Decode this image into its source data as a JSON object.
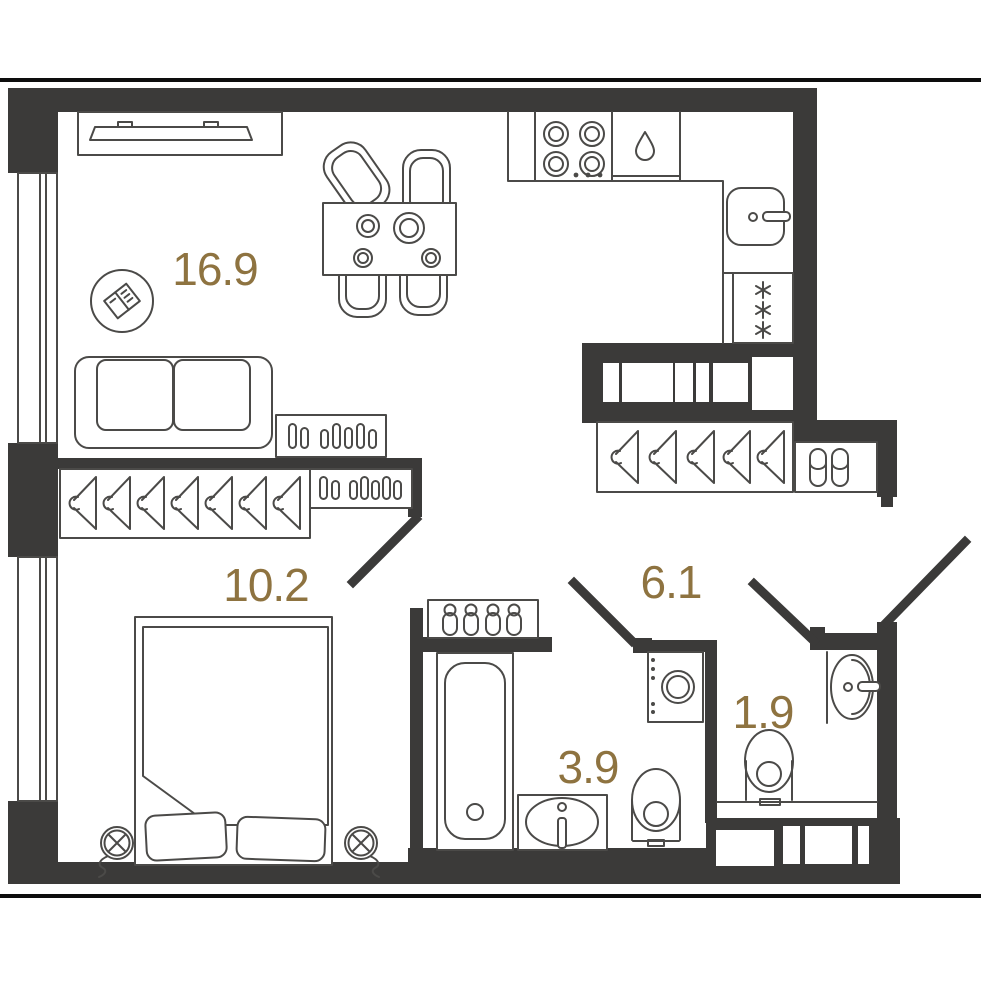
{
  "plan": {
    "accent_color": "#8e7340",
    "wall_color": "#3b3a39",
    "line_color": "#4b4a48",
    "background_color": "#ffffff",
    "rooms": [
      {
        "id": "living-kitchen",
        "area_label": "16.9"
      },
      {
        "id": "bedroom",
        "area_label": "10.2"
      },
      {
        "id": "hallway",
        "area_label": "6.1"
      },
      {
        "id": "bathroom",
        "area_label": "3.9"
      },
      {
        "id": "wc",
        "area_label": "1.9"
      }
    ],
    "furniture_icons": [
      "tv-icon",
      "dining-table-icon",
      "chair-icon",
      "decor-book-icon",
      "sofa-icon",
      "radiator-icon",
      "kitchen-counter-icon",
      "stove-icon",
      "dishwasher-drop-icon",
      "kitchen-sink-icon",
      "fridge-snowflakes-icon",
      "wardrobe-icon",
      "coat-hanger-icon",
      "slippers-icon",
      "towel-hooks-icon",
      "bathtub-icon",
      "washbasin-icon",
      "toilet-icon",
      "washing-machine-icon",
      "bed-icon",
      "pillow-icon",
      "bedside-lamp-icon",
      "door-leaf-icon",
      "window-icon",
      "vent-shaft-icon"
    ]
  }
}
